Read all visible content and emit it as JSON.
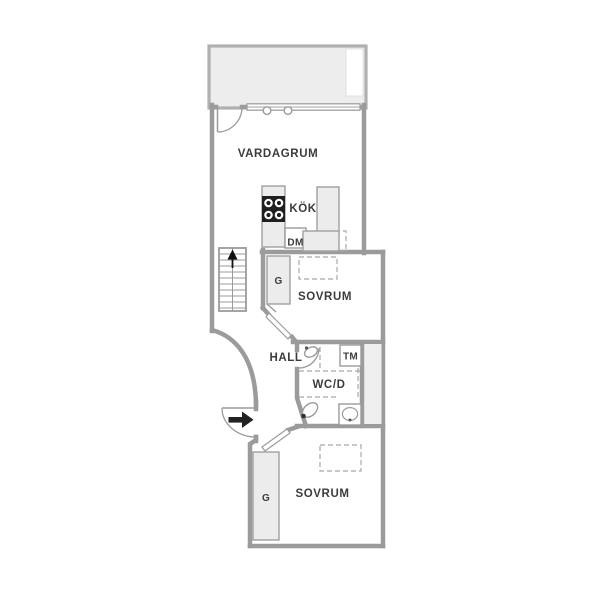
{
  "labels": {
    "living_room": "VARDAGRUM",
    "kitchen": "KÖK",
    "dishwasher": "DM",
    "bedroom_upper": "SOVRUM",
    "wardrobe_upper": "G",
    "hall": "HALL",
    "bathroom": "WC/D",
    "washing_machine": "TM",
    "bedroom_lower": "SOVRUM",
    "wardrobe_lower": "G"
  },
  "colors": {
    "wall": "#9b9b9b",
    "counter_fill": "#ececec",
    "balcony_fill": "#ededed",
    "stove": "#1f1f1f",
    "text": "#3c3c3c",
    "background": "#ffffff"
  }
}
